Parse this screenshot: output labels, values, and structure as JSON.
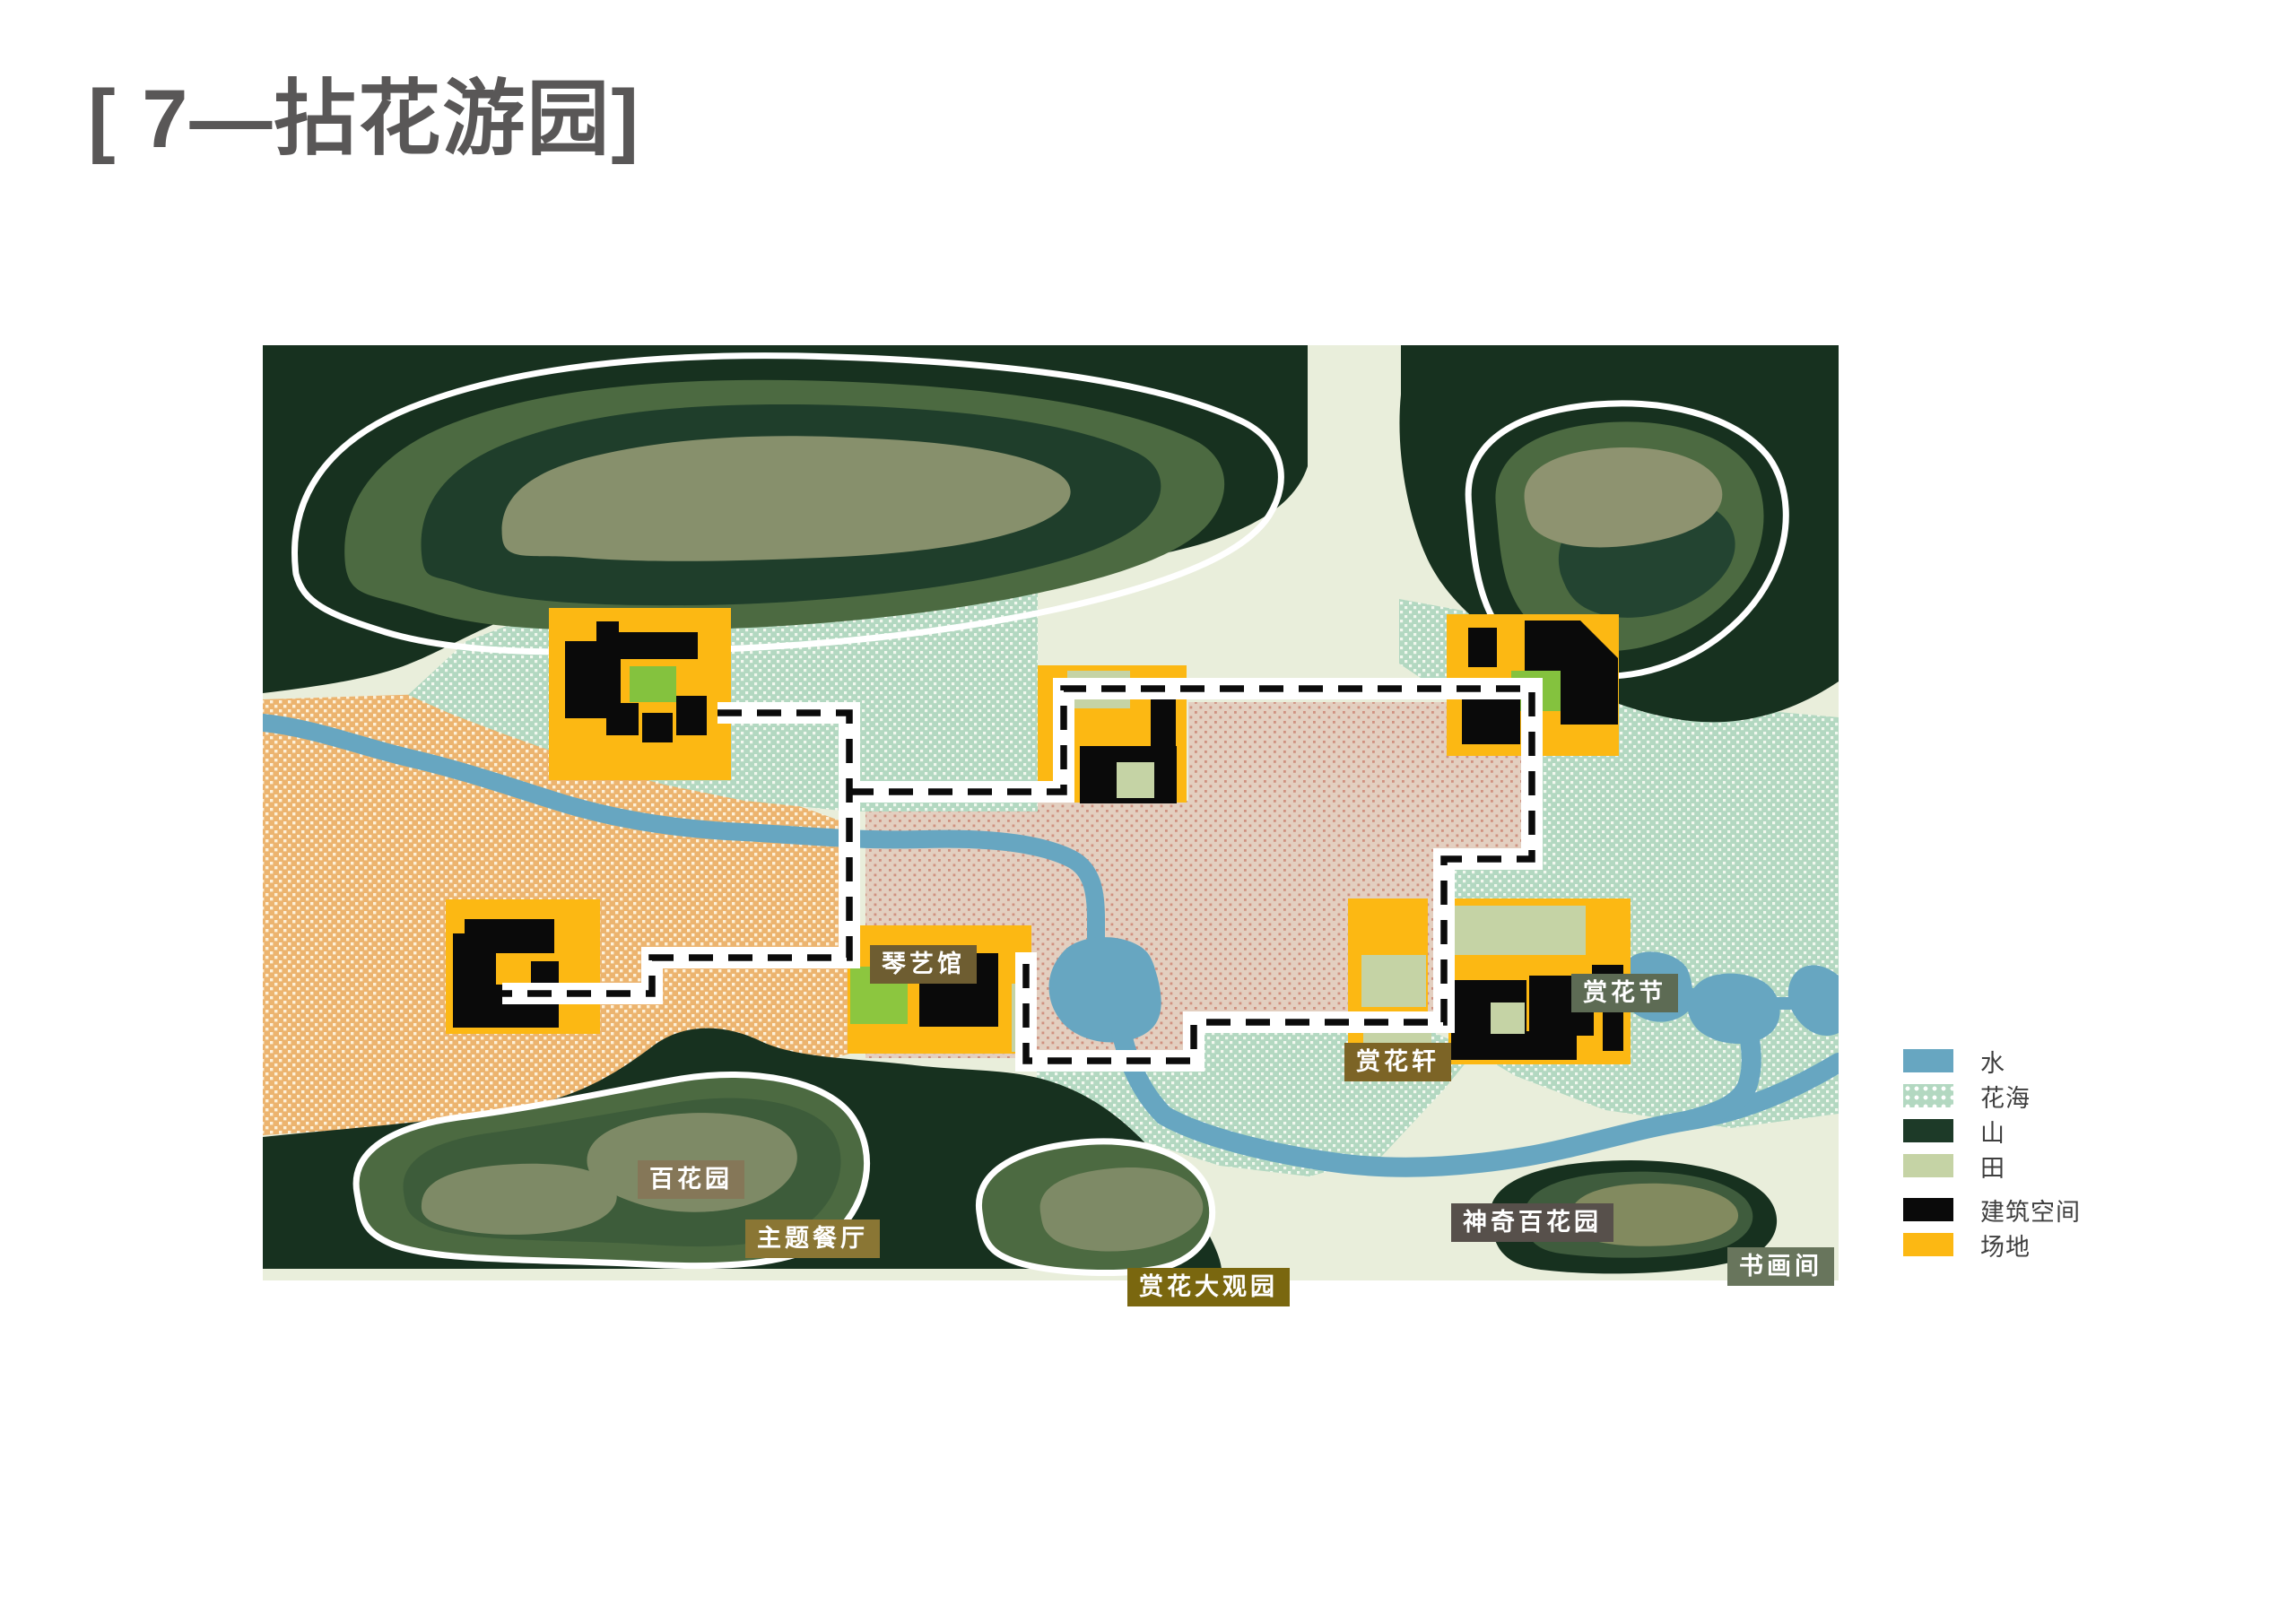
{
  "title": "[ 7—拈花游园]",
  "map": {
    "labels": {
      "qinyiguan": {
        "text": "琴艺馆",
        "bg": "#6e5d31"
      },
      "shanghuajie": {
        "text": "赏花节",
        "bg": "#5d6b54"
      },
      "shanghuaxuan": {
        "text": "赏花轩",
        "bg": "#7c6426"
      },
      "baihuayuan": {
        "text": "百花园",
        "bg": "#857758"
      },
      "zhuticanting": {
        "text": "主题餐厅",
        "bg": "#8a7634"
      },
      "shenqibaihuayuan": {
        "text": "神奇百花园",
        "bg": "#57504b"
      },
      "shanghuadaguanyuan": {
        "text": "赏花大观园",
        "bg": "#7a670f"
      },
      "shuhuajian": {
        "text": "书画间",
        "bg": "#68755c"
      }
    }
  },
  "legend": {
    "items": [
      {
        "label": "水",
        "color": "#67a6c1",
        "pattern": "solid"
      },
      {
        "label": "花海",
        "color": "#b3d8c1",
        "pattern": "dots"
      },
      {
        "label": "山",
        "color": "#1d3a28",
        "pattern": "solid"
      },
      {
        "label": "田",
        "color": "#c5d3a5",
        "pattern": "solid"
      },
      {
        "label": "建筑空间",
        "color": "#0a0a0a",
        "pattern": "solid"
      },
      {
        "label": "场地",
        "color": "#fcb813",
        "pattern": "solid"
      }
    ]
  },
  "colors": {
    "title_text": "#595757",
    "map_background": "#e9eedb",
    "water": "#67a6c1",
    "flower_sea_base": "#b3d8c1",
    "flower_garden_tan": "#ecb46f",
    "magic_garden_pink": "#e3cfc0",
    "mountain_dark": "#17311f",
    "mountain_mid": "#4c6a41",
    "mountain_core": "#87906c",
    "field": "#c5d3a5",
    "building": "#0a0a0a",
    "site_yellow": "#fcb813",
    "lawn_green": "#84c23e",
    "path_white": "#ffffff",
    "path_dash": "#0b0b0b"
  }
}
